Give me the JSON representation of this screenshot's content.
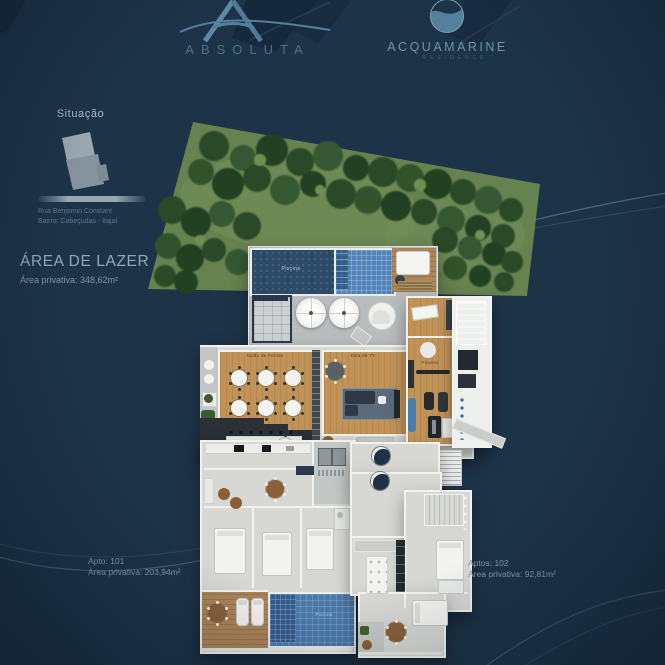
{
  "colors": {
    "background": "#1d3348",
    "accent-steel": "#54809e",
    "text-light": "#9db4c6",
    "text-muted": "#6d8499",
    "pool-dark": "#2d4b68",
    "pool-tile": "#4f83ba",
    "wood": "#c19357",
    "garden": "#66824f"
  },
  "brands": {
    "absoluta": {
      "name": "ABSOLUTA"
    },
    "acquamarine": {
      "name": "ACQUAMARINE",
      "subtitle": "RESIDENCE"
    }
  },
  "situacao": {
    "title": "Situação",
    "street": "Rua Benjamin Constant",
    "district": "Bairro: Cabeçudas - Itajaí"
  },
  "leisure": {
    "title": "ÁREA DE LAZER",
    "area": "Área privativa: 348,62m²"
  },
  "units": [
    {
      "label": "Apto: 101",
      "area": "Área privativa: 203,94m²"
    },
    {
      "label": "Aptos: 102",
      "area": "Área privativa: 92,81m²"
    }
  ],
  "plan_labels": {
    "main_pool": "Piscina",
    "party_room": "Salão de Festas",
    "tv_room": "Sala de TV",
    "fitness": "Fitness",
    "apt_pool": "Piscina"
  }
}
